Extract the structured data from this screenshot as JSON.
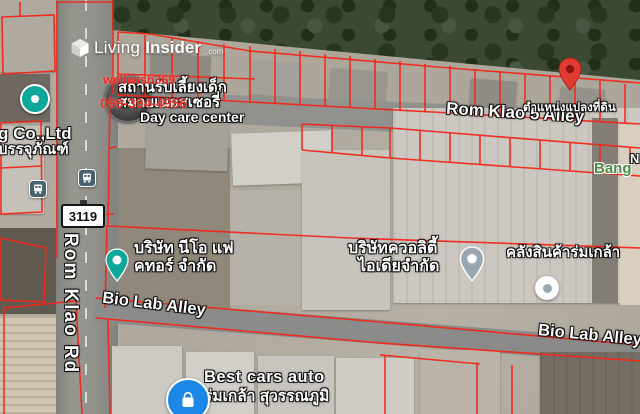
{
  "watermark": {
    "brand_light": "Living",
    "brand_bold": "Insider",
    "brand_tld": ".com",
    "agent_id": "wellwish369",
    "phone": "099-394-4956"
  },
  "roads": {
    "vertical_road": "Rom Klao Rd",
    "top_alley": "Rom Klao 5 Alley",
    "mid_alley_west": "Bio Lab Alley",
    "mid_alley_east": "Bio Lab Alley",
    "route_number": "3119"
  },
  "labels": {
    "daycare": {
      "thai_line1": "สถานรับเลี้ยงเด็ก",
      "thai_line2": "สมายเนอสเซอรี่",
      "english": "Day care center"
    },
    "left_company": {
      "english_fragment": "g Co.,Ltd",
      "thai_fragment": "บรรจุภัณฑ์"
    },
    "neo_factor": {
      "line1": "บริษัท นีโอ แฟ",
      "line2": "คทอร์ จำกัด"
    },
    "quality_idea": {
      "line1": "บริษัทควอลิตี้",
      "line2": "ไอเดียจำกัด"
    },
    "warehouse": "คลังสินค้าร่มเกล้า",
    "plot_marker_caption": "ตำแหน่งแปลงที่ดิน",
    "locality_fragment": "Bang",
    "edge_fragment": "N",
    "best_cars": {
      "line1": "Best cars auto",
      "line2": "ร่มเกล้า สุวรรณภูมิ"
    }
  },
  "icons": {
    "brand-cube-icon": "white 3d cube",
    "plot-pin-icon": "red map pin (land plot position)",
    "neo-factor-pin-icon": "teal map pin",
    "quality-idea-pin-icon": "grey map pin",
    "shop-dot-pin-icon": "grey dot pin",
    "teal-dot-pin-icon": "teal dot pin",
    "bus-stop-icon": "bus in rounded square",
    "store-icon": "shopping bag in blue circle",
    "route-shield": "white rectangle with route number"
  },
  "colors": {
    "parcel-red": "#f2261b",
    "marker-red": "#e03b30",
    "pin-teal": "#0ea89b",
    "pin-grey": "#9aa7b0",
    "poi-blue": "#1d87e8",
    "locality-green": "#4a8c46",
    "watermark-red": "#e62e25",
    "transit-slate": "#48626e"
  }
}
